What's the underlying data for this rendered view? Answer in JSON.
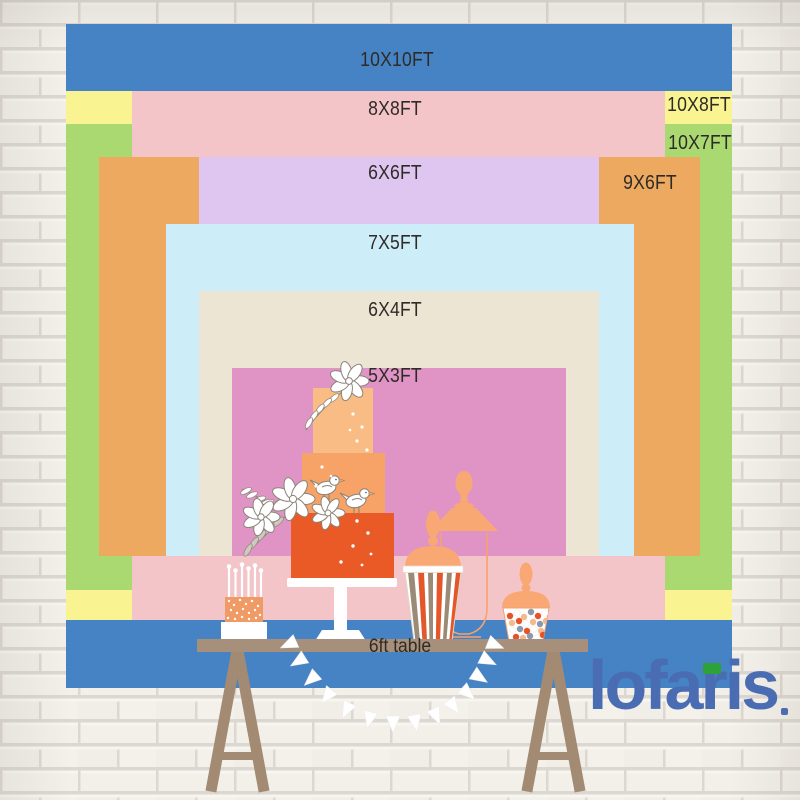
{
  "backdrop": {
    "sizes": [
      {
        "label": "10X10FT",
        "color": "#4583c4"
      },
      {
        "label": "10X8FT",
        "color": "#f9f392"
      },
      {
        "label": "10X7FT",
        "color": "#a9d970"
      },
      {
        "label": "8X8FT",
        "color": "#f4c5c8"
      },
      {
        "label": "9X6FT",
        "color": "#eda95f"
      },
      {
        "label": "6X6FT",
        "color": "#dfc6f0"
      },
      {
        "label": "7X5FT",
        "color": "#cdeef8"
      },
      {
        "label": "6X4FT",
        "color": "#ece5d3"
      },
      {
        "label": "5X3FT",
        "color": "#e094c5"
      }
    ],
    "table": {
      "label": "6ft table",
      "color": "#a7907b"
    }
  },
  "logo": {
    "text": "lofaris",
    "mark": ".",
    "color": "#4a6cb3",
    "flag_color": "#2ea13b"
  },
  "scene": {
    "wall": "white-brick-wall",
    "props": [
      "three-tier-cake",
      "mini-cake-with-candles",
      "striped-candy-cup",
      "apothecary-jar",
      "candy-jar",
      "bunting-garland",
      "trestle-table"
    ]
  }
}
